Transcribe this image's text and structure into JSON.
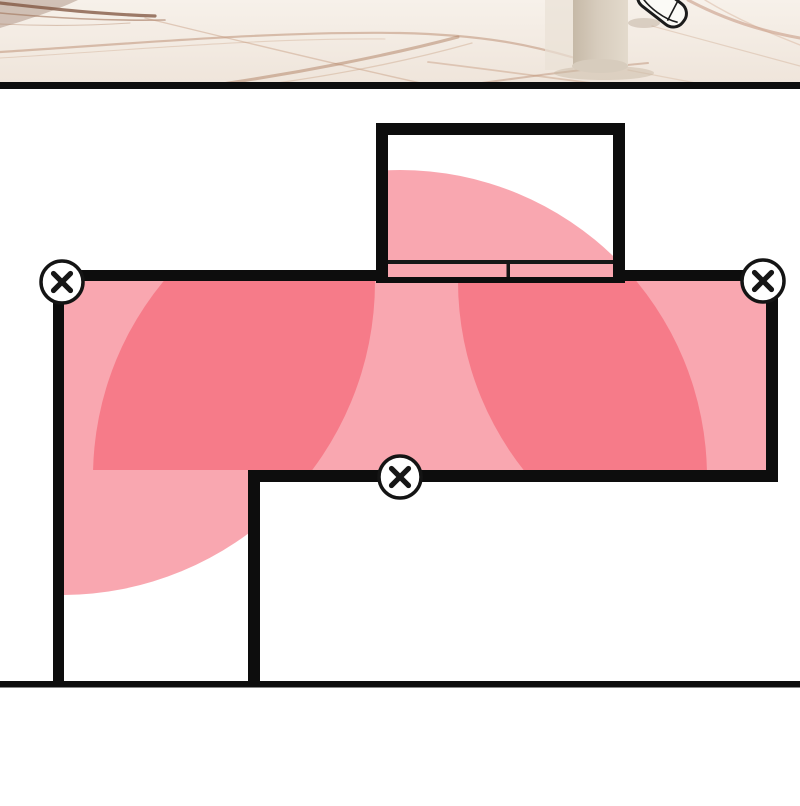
{
  "scene": {
    "title_hint": "comic-floorplan-panel",
    "colors": {
      "background": "#ffffff",
      "wall": "#0d0d0d",
      "zone_fill": "#F34F61",
      "zone_opacity": 0.5,
      "zone_single_result": "#F9A7B0",
      "zone_overlap_result": "#F67B88",
      "door_fill": "#F9A7B0",
      "door_line": "#161616",
      "marble_base_top": "#F7F1EA",
      "marble_base_bottom": "#EFE5DB",
      "pillar": "#D7CCBD",
      "pillar_dark": "#C6B9A7",
      "shoe_fill": "#FBFAF6",
      "shoe_outline": "#1c1c1c",
      "marker_fill": "#ffffff",
      "marker_stroke": "#141414",
      "marker_glyph": "#161616"
    },
    "borders": {
      "top": [
        0,
        82,
        800,
        7
      ],
      "bottom": [
        0,
        681,
        800,
        6.5
      ]
    },
    "markers": [
      {
        "id": "disabled-camera-left",
        "symbol": "x",
        "cx": 62,
        "cy": 282,
        "r": 21
      },
      {
        "id": "disabled-camera-right",
        "symbol": "x",
        "cx": 763,
        "cy": 281,
        "r": 21
      },
      {
        "id": "disabled-camera-bottom",
        "symbol": "x",
        "cx": 400,
        "cy": 477,
        "r": 21
      }
    ],
    "zones": [
      {
        "id": "coverage-left-camera",
        "cx": 62,
        "cy": 282,
        "r": 313,
        "clip": "clip-left"
      },
      {
        "id": "coverage-bottom-camera",
        "cx": 400,
        "cy": 477,
        "r": 307,
        "clip": "clip-mid"
      },
      {
        "id": "coverage-right-camera",
        "cx": 763,
        "cy": 281,
        "r": 305,
        "clip": "clip-right"
      }
    ],
    "clips": {
      "main_room": [
        64,
        281,
        702,
        189
      ],
      "corridor": [
        64,
        281,
        184,
        396
      ],
      "closet": [
        388,
        135,
        225,
        146
      ]
    },
    "walls": [
      {
        "id": "top-wall-left",
        "r": [
          53,
          270,
          325,
          11
        ]
      },
      {
        "id": "top-wall-right",
        "r": [
          624,
          270,
          154,
          11
        ]
      },
      {
        "id": "left-wall",
        "r": [
          53,
          270,
          11,
          417
        ]
      },
      {
        "id": "right-wall",
        "r": [
          766,
          270,
          12,
          212
        ]
      },
      {
        "id": "bottom-wall-main",
        "r": [
          248,
          470,
          530,
          12
        ]
      },
      {
        "id": "corridor-wall",
        "r": [
          248,
          470,
          12,
          217
        ]
      },
      {
        "id": "closet-left-wall",
        "r": [
          376,
          123,
          12,
          160
        ]
      },
      {
        "id": "closet-right-wall",
        "r": [
          613,
          123,
          12,
          160
        ]
      },
      {
        "id": "closet-top-wall",
        "r": [
          376,
          123,
          249,
          12
        ]
      }
    ],
    "door": {
      "panel_rect": [
        388,
        261,
        225,
        18
      ],
      "top_line": [
        388,
        260,
        225,
        4
      ],
      "divider": [
        506.5,
        260,
        3.5,
        19
      ],
      "bottom_bar": [
        376,
        277,
        249,
        6
      ]
    },
    "marble": {
      "strip_rect": [
        0,
        0,
        800,
        82
      ],
      "back_strip": [
        545,
        0,
        28,
        70
      ],
      "pillar": {
        "x": 573,
        "y": 0,
        "w": 55,
        "h": 66,
        "base_cx": 600,
        "base_cy": 66,
        "base_rx": 28,
        "base_ry": 7,
        "shadow_cx": 604,
        "shadow_cy": 73,
        "shadow_rx": 50,
        "shadow_ry": 7
      },
      "shoe": {
        "cx": 662,
        "cy": 5,
        "rot": 38,
        "w": 54,
        "h": 26,
        "rx": 12
      },
      "veins": [
        {
          "d": "M0,0 L78,0 C52,12 26,20 0,28 Z",
          "c": "#6E452F",
          "w": 0,
          "o": 0.28,
          "fill": true
        },
        {
          "d": "M0,3 C45,8 95,14 155,16",
          "c": "#7E523C",
          "w": 3.2,
          "o": 0.75
        },
        {
          "d": "M0,13 C55,18 105,21 165,20",
          "c": "#9A6B50",
          "w": 1.6,
          "o": 0.55
        },
        {
          "d": "M0,24 C40,26 85,26 130,23",
          "c": "#B08364",
          "w": 1.1,
          "o": 0.4
        },
        {
          "d": "M0,52 C130,44 270,31 400,33 C485,35 530,45 575,58",
          "c": "#B98A6E",
          "w": 2.2,
          "o": 0.5
        },
        {
          "d": "M0,58 C120,51 255,38 385,39",
          "c": "#C9A183",
          "w": 1.1,
          "o": 0.35
        },
        {
          "d": "M145,18 C235,40 330,63 425,84",
          "c": "#C09272",
          "w": 1.4,
          "o": 0.4
        },
        {
          "d": "M208,86 C300,73 390,55 458,37",
          "c": "#AF7F61",
          "w": 3.0,
          "o": 0.5
        },
        {
          "d": "M220,90 C315,80 405,62 472,43",
          "c": "#C9A183",
          "w": 1.3,
          "o": 0.4
        },
        {
          "d": "M395,95 C490,82 570,70 648,63",
          "c": "#B98A6E",
          "w": 2.0,
          "o": 0.45
        },
        {
          "d": "M428,62 C520,73 615,87 705,97",
          "c": "#C09272",
          "w": 1.8,
          "o": 0.4
        },
        {
          "d": "M688,0 C718,16 755,30 800,38",
          "c": "#C08C74",
          "w": 3.0,
          "o": 0.5
        },
        {
          "d": "M705,0 C738,20 772,34 800,45",
          "c": "#D3A78E",
          "w": 1.4,
          "o": 0.4
        },
        {
          "d": "M652,26 C705,40 758,55 800,66",
          "c": "#C9A183",
          "w": 1.2,
          "o": 0.35
        },
        {
          "d": "M628,70 C680,80 740,92 800,100",
          "c": "#C9A183",
          "w": 1.2,
          "o": 0.3
        }
      ]
    }
  }
}
